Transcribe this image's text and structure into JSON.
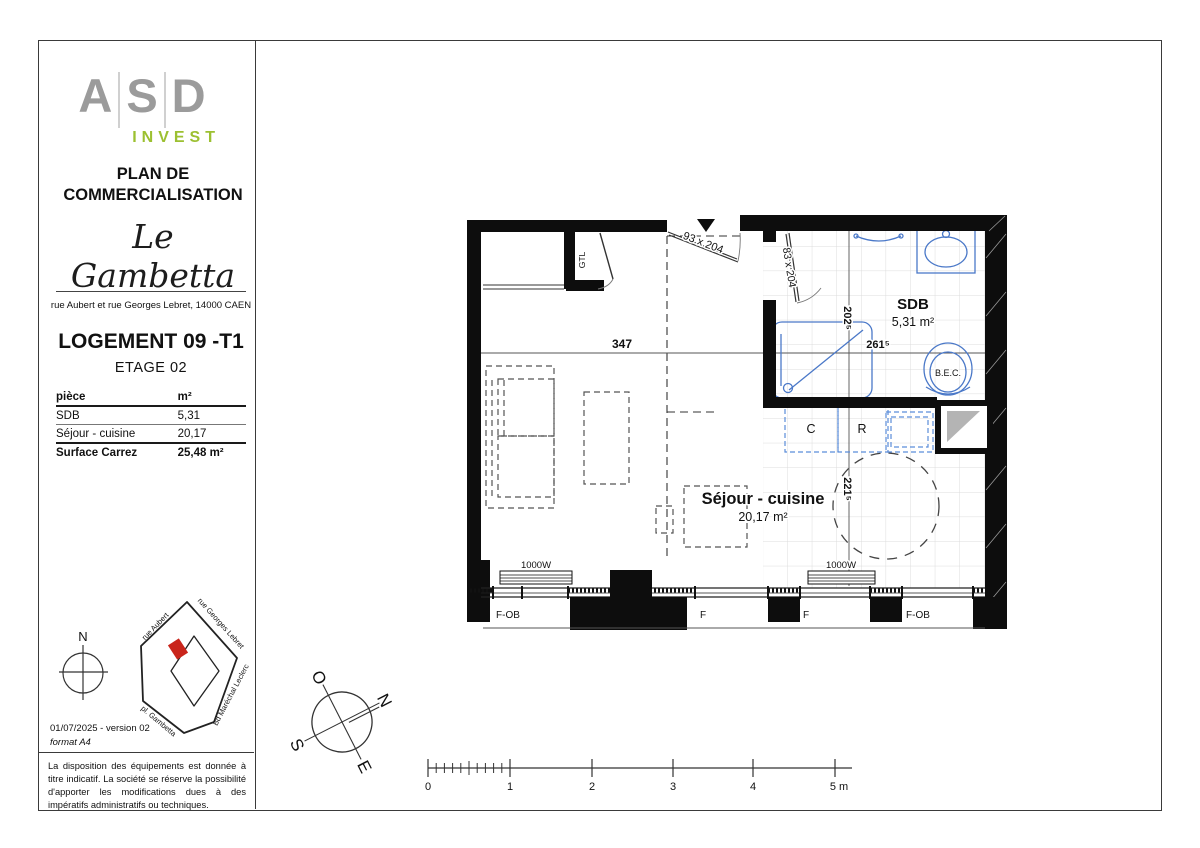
{
  "document": {
    "logo": {
      "letter_a": "A",
      "letter_s": "S",
      "letter_d": "D",
      "subtitle": "INVEST",
      "accent_color": "#9cc031",
      "letter_color": "#9b9b9b"
    },
    "doc_type": "PLAN DE COMMERCIALISATION",
    "project_name": "Le Gambetta",
    "address": "rue Aubert et rue Georges Lebret, 14000 CAEN",
    "unit_title": "LOGEMENT 09 -T1",
    "floor_label": "ETAGE 02",
    "area_table": {
      "header": {
        "room": "pièce",
        "area": "m²"
      },
      "rows": [
        {
          "room": "SDB",
          "area": "5,31"
        },
        {
          "room": "Séjour - cuisine",
          "area": "20,17"
        }
      ],
      "total": {
        "label": "Surface Carrez",
        "value": "25,48 m²"
      }
    },
    "north_arrow_label": "N",
    "site_map": {
      "streets": {
        "top_left": "rue Aubert",
        "top_right": "rue Georges Lebret",
        "bottom_left": "pl. Gambetta",
        "bottom_right": "Bd Maréchal Leclerc"
      },
      "marker_color": "#c9251b"
    },
    "version": "01/07/2025 - version 02",
    "format": "format A4",
    "disclaimer": "La disposition des équipements est donnée à titre indicatif. La société se réserve la possibilité d'apporter les modifications dues à des impératifs administratifs ou techniques."
  },
  "plan": {
    "rooms": {
      "sdb": {
        "name": "SDB",
        "area": "5,31 m²"
      },
      "sejour": {
        "name": "Séjour - cuisine",
        "area": "20,17 m²"
      }
    },
    "dimensions": {
      "living_width": "347",
      "sdb_width": "261⁵",
      "sdb_depth": "202⁵",
      "kitchen_depth": "221⁵"
    },
    "doors": {
      "entrance": "93 x 204",
      "bathroom": "83 x 204"
    },
    "equipment": {
      "gtl": "GTL",
      "water_heater": "B.E.C.",
      "cooker": "C",
      "fridge": "R",
      "radiator": "1000W"
    },
    "windows": {
      "w1": "F-OB",
      "w2": "F",
      "w3": "F",
      "w4": "F-OB"
    },
    "fixture_color": "#4a78c8"
  },
  "compass": {
    "west": "O",
    "north": "N",
    "south": "S",
    "east": "E"
  },
  "scale_bar": {
    "labels": [
      "0",
      "1",
      "2",
      "3",
      "4",
      "5 m"
    ]
  }
}
